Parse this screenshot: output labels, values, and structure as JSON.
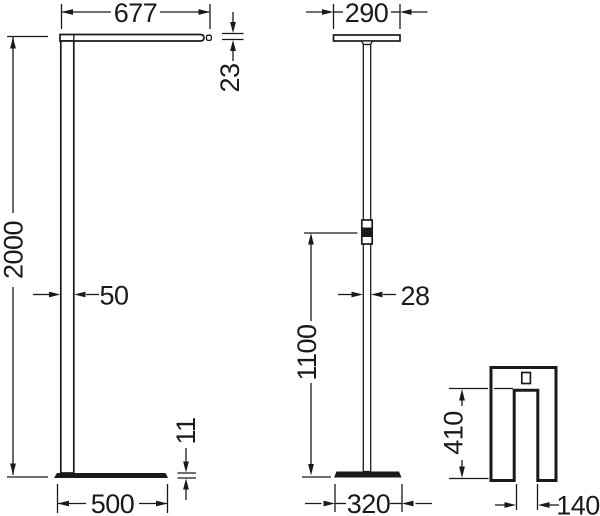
{
  "diagram": {
    "front_view": {
      "head_width": "677",
      "head_thickness": "23",
      "overall_height": "2000",
      "pole_depth": "50",
      "base_plate_thickness": "11",
      "base_length": "500"
    },
    "side_view": {
      "head_depth": "290",
      "pole_width": "28",
      "control_height": "1100",
      "base_width": "320"
    },
    "top_view": {
      "cutout_depth": "410",
      "cutout_width": "140"
    },
    "colors": {
      "line": "#1a1a1a",
      "background": "#ffffff"
    }
  }
}
